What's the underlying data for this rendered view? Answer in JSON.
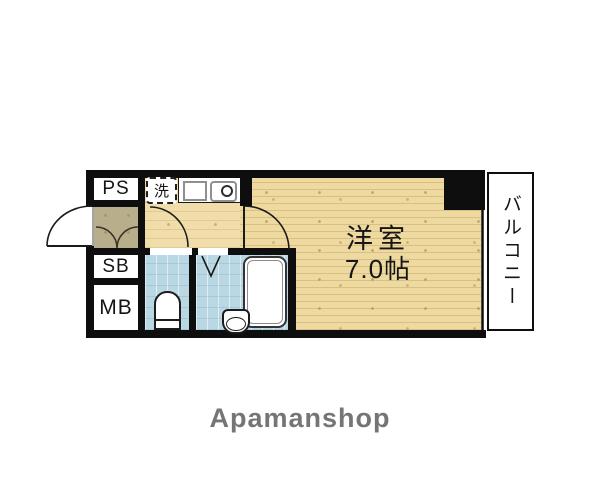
{
  "plan": {
    "compartments": {
      "ps": "PS",
      "sb": "SB",
      "mb": "MB",
      "washer": "洗",
      "room": {
        "name": "洋室",
        "size": "7.0帖"
      },
      "balcony": "バルコニー"
    },
    "branding": {
      "logo": "Apamanshop"
    },
    "colors": {
      "wall": "#0e0e0e",
      "wood_floor": "#eed9a1",
      "kitchen_floor": "#f0dda9",
      "entry_floor": "#b8ae8c",
      "wet_area": "#b9d8e3",
      "balcony_bg": "#ffffff",
      "logo_gray": "#757575"
    }
  }
}
